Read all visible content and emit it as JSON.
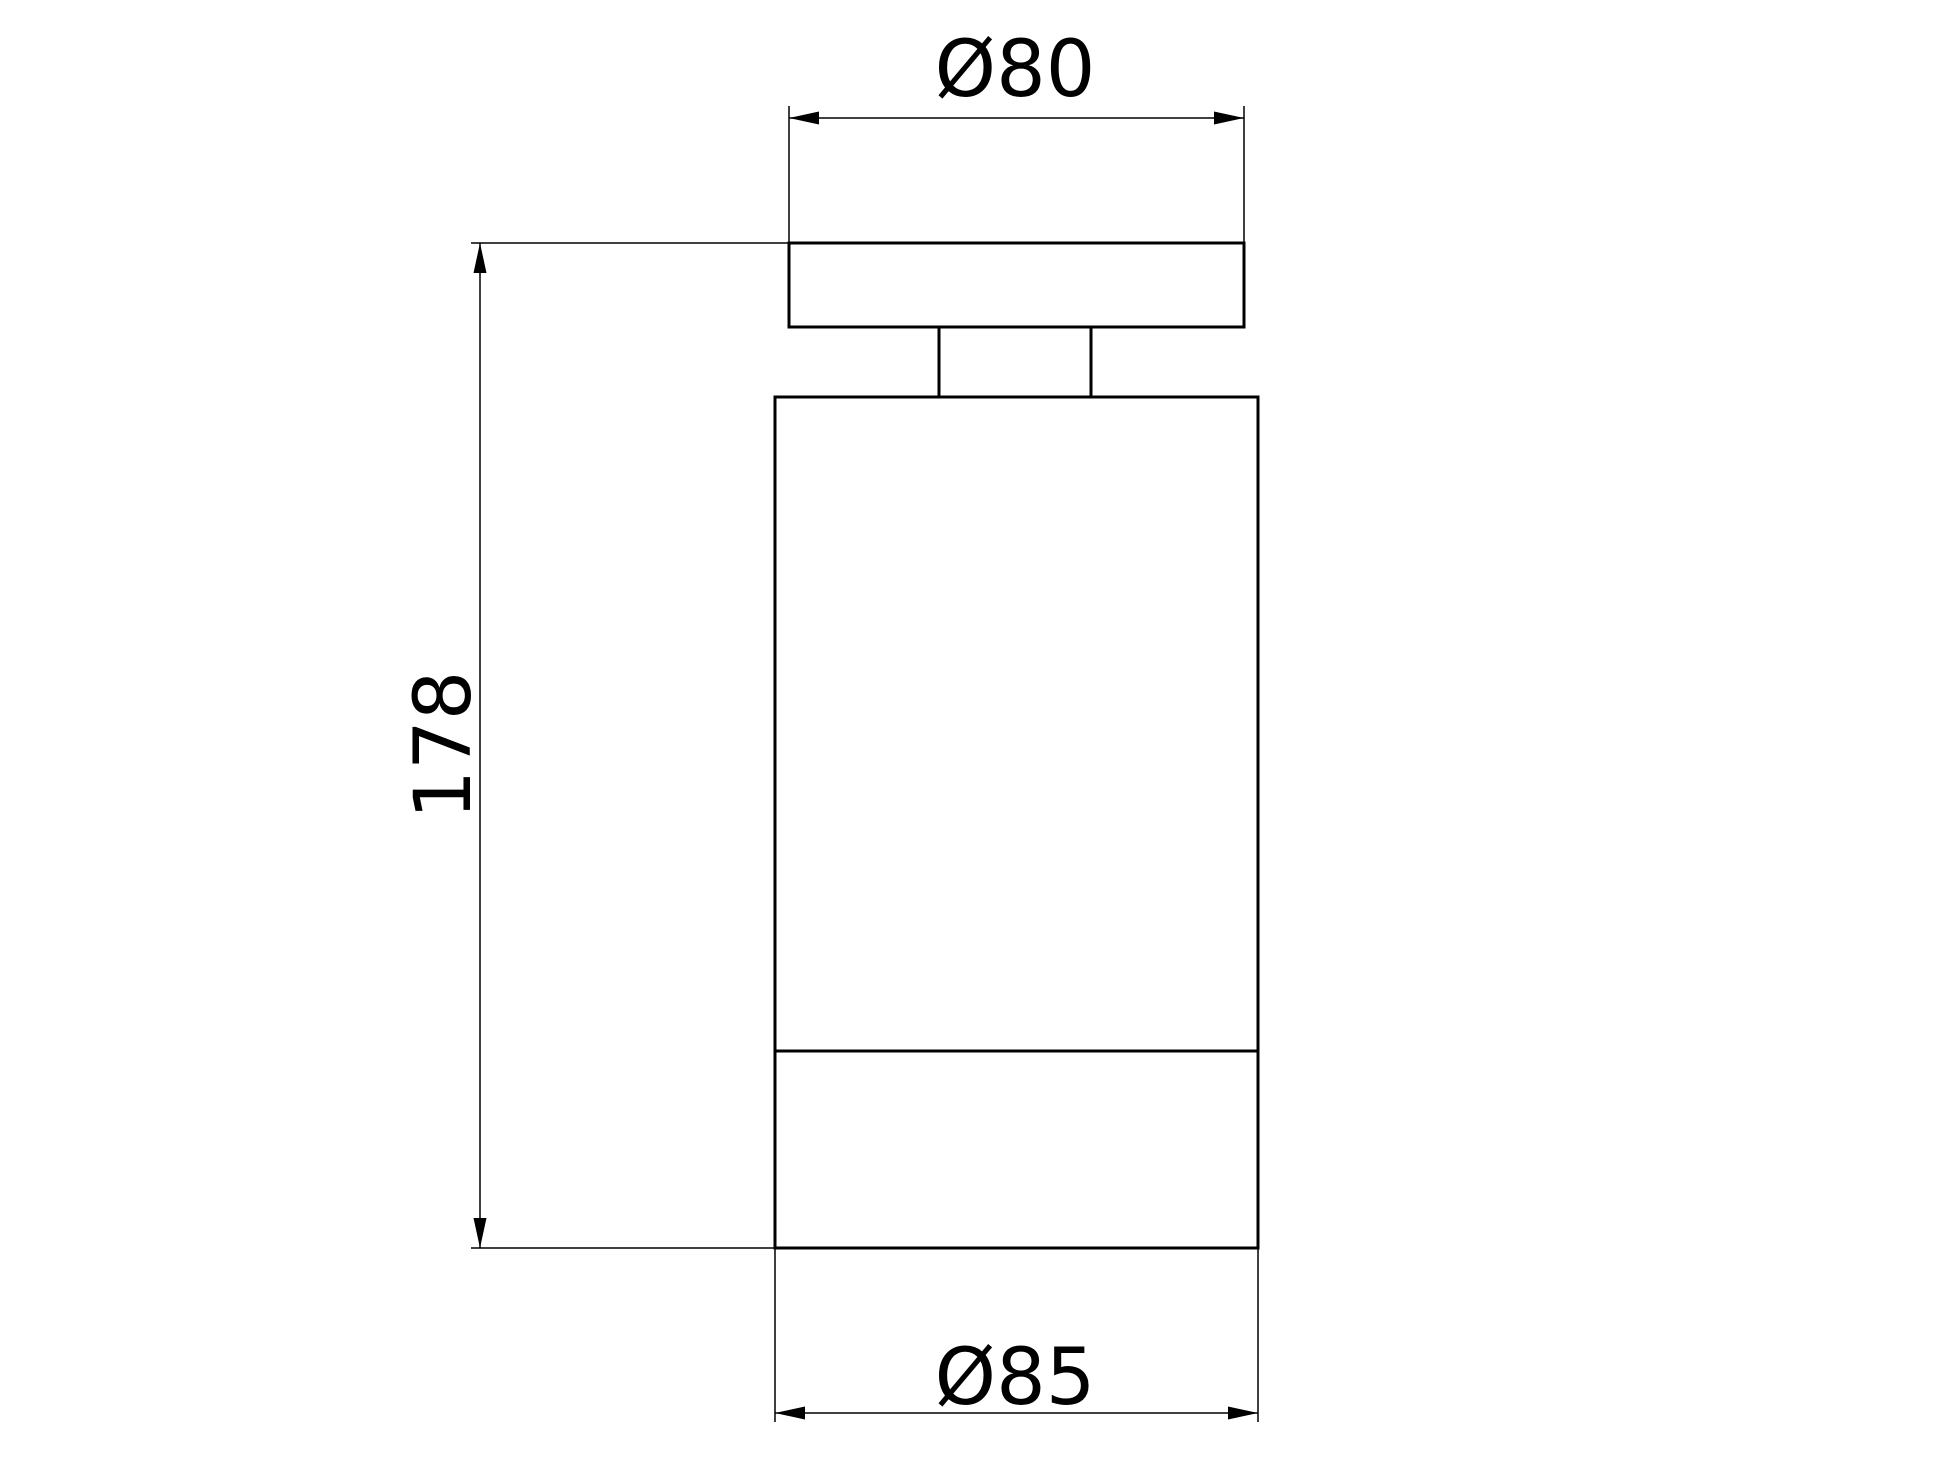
{
  "drawing": {
    "background_color": "#ffffff",
    "line_color": "#000000",
    "view": "front-elevation",
    "parts": [
      "mounting-plate",
      "neck",
      "lamp-body",
      "front-bezel"
    ],
    "dimensions": {
      "top_diameter": {
        "label": "Ø80",
        "value": 80,
        "symbol": "diameter"
      },
      "overall_height": {
        "label": "178",
        "value": 178
      },
      "bottom_diameter": {
        "label": "Ø85",
        "value": 85,
        "symbol": "diameter"
      }
    }
  }
}
